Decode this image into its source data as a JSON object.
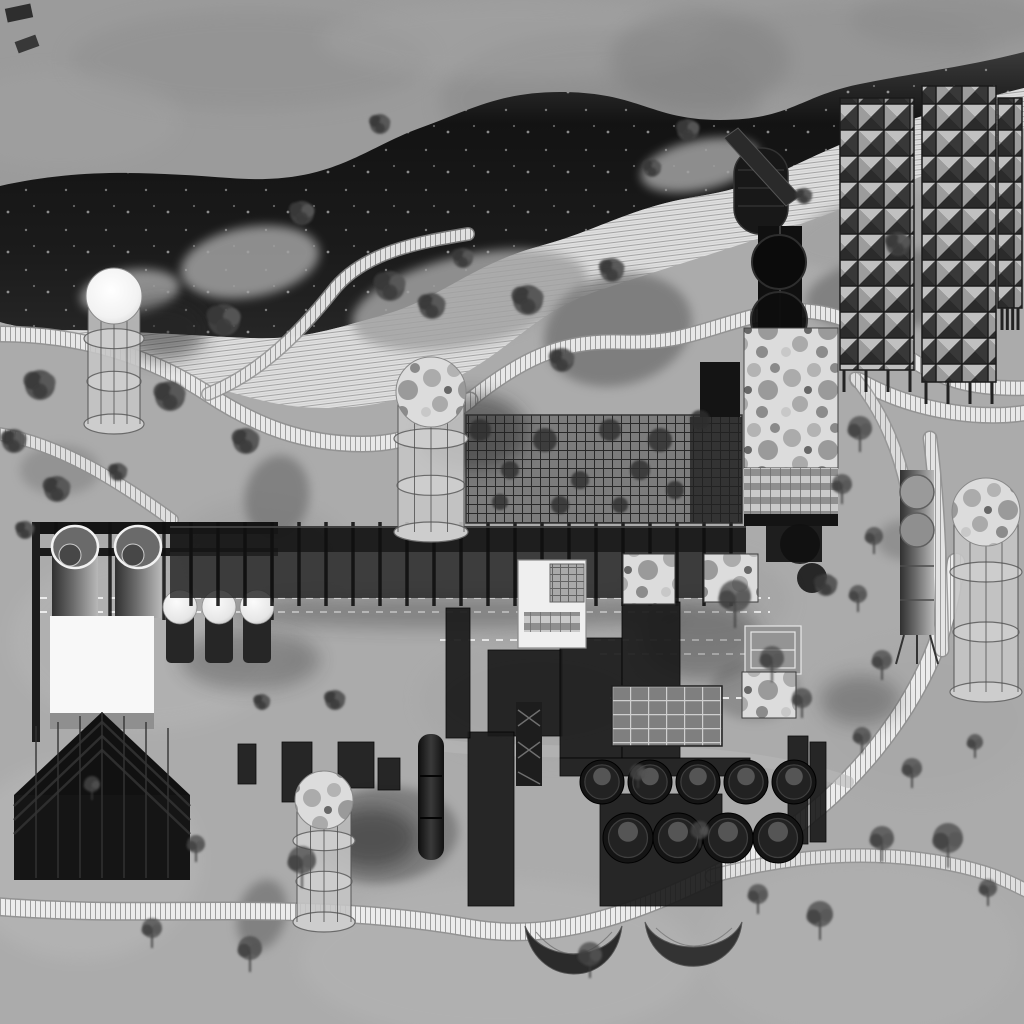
{
  "meta": {
    "title": "industrial-park-masterplan-rendering",
    "view": "aerial site plan, grayscale architectural rendering",
    "visible_text": []
  },
  "palette": {
    "ground": "#ababab",
    "ground-light": "#bfbfbf",
    "sky": "#9b9b9b",
    "hill": "#161616",
    "stripe-bg": "#e3e3e3",
    "stripe-line": "#a3a3a3",
    "boardwalk": "#ececec",
    "pond": "#6f6f6f",
    "structure-dark": "#141414",
    "structure-mid": "#2c2c2c",
    "concrete": "#c6c6c6",
    "white": "#f8f8f8",
    "mottle": "#dcdcdc",
    "glass": "#c9c9c9",
    "tree": "#454545",
    "shadow": "#262626"
  },
  "features": {
    "clouds": [
      {
        "x": 250,
        "y": 60,
        "rx": 180,
        "ry": 50,
        "c": "#8e8e8e",
        "o": 0.5
      },
      {
        "x": 600,
        "y": 100,
        "rx": 160,
        "ry": 70,
        "c": "#878787",
        "o": 0.5
      },
      {
        "x": 520,
        "y": 40,
        "rx": 200,
        "ry": 40,
        "c": "#a6a6a6",
        "o": 0.4
      },
      {
        "x": 840,
        "y": 50,
        "rx": 150,
        "ry": 45,
        "c": "#909090",
        "o": 0.45
      },
      {
        "x": 60,
        "y": 120,
        "rx": 120,
        "ry": 50,
        "c": "#a3a3a3",
        "o": 0.4
      },
      {
        "x": 950,
        "y": 20,
        "rx": 100,
        "ry": 30,
        "c": "#858585",
        "o": 0.4
      },
      {
        "x": 700,
        "y": 60,
        "rx": 90,
        "ry": 50,
        "c": "#7d7d7d",
        "o": 0.45
      }
    ],
    "groundPatches": [
      {
        "x": 150,
        "y": 640,
        "rx": 140,
        "ry": 90,
        "c": "#bcbcbc",
        "o": 0.35
      },
      {
        "x": 80,
        "y": 860,
        "rx": 120,
        "ry": 100,
        "c": "#c0c0c0",
        "o": 0.35
      },
      {
        "x": 500,
        "y": 960,
        "rx": 200,
        "ry": 80,
        "c": "#bdbdbd",
        "o": 0.3
      },
      {
        "x": 860,
        "y": 950,
        "rx": 160,
        "ry": 90,
        "c": "#b5b5b5",
        "o": 0.3
      },
      {
        "x": 920,
        "y": 720,
        "rx": 120,
        "ry": 80,
        "c": "#a5a5a5",
        "o": 0.35
      },
      {
        "x": 260,
        "y": 560,
        "rx": 90,
        "ry": 60,
        "c": "#989898",
        "o": 0.35
      },
      {
        "x": 700,
        "y": 600,
        "rx": 90,
        "ry": 50,
        "c": "#9a9a9a",
        "o": 0.3
      },
      {
        "x": 540,
        "y": 700,
        "rx": 120,
        "ry": 60,
        "c": "#a0a0a0",
        "o": 0.3
      }
    ],
    "ponds": [
      {
        "x": 618,
        "y": 330,
        "rx": 75,
        "ry": 55,
        "rot": -15,
        "o": 0.75
      },
      {
        "x": 900,
        "y": 290,
        "rx": 95,
        "ry": 38,
        "rot": -8,
        "o": 0.7
      },
      {
        "x": 277,
        "y": 497,
        "rx": 32,
        "ry": 42,
        "rot": 10,
        "o": 0.7
      },
      {
        "x": 383,
        "y": 835,
        "rx": 75,
        "ry": 48,
        "rot": -5,
        "o": 0.75
      },
      {
        "x": 262,
        "y": 915,
        "rx": 24,
        "ry": 36,
        "rot": 15,
        "o": 0.7
      },
      {
        "x": 60,
        "y": 470,
        "rx": 40,
        "ry": 25,
        "rot": 0,
        "o": 0.4
      },
      {
        "x": 755,
        "y": 690,
        "rx": 45,
        "ry": 30,
        "rot": 0,
        "o": 0.5
      },
      {
        "x": 905,
        "y": 540,
        "rx": 28,
        "ry": 20,
        "rot": 0,
        "o": 0.45
      }
    ],
    "grassIslands": [
      {
        "x": 470,
        "y": 300,
        "rx": 120,
        "ry": 45,
        "rot": -12
      },
      {
        "x": 250,
        "y": 262,
        "rx": 70,
        "ry": 35,
        "rot": -10
      },
      {
        "x": 700,
        "y": 165,
        "rx": 60,
        "ry": 25,
        "rot": -12
      },
      {
        "x": 880,
        "y": 232,
        "rx": 90,
        "ry": 35,
        "rot": -10
      },
      {
        "x": 130,
        "y": 292,
        "rx": 50,
        "ry": 22,
        "rot": -8
      }
    ],
    "boardwalks": [
      {
        "d": "M-10,906 C150,920 300,898 470,928 C560,944 645,908 712,876 C800,834 862,776 906,706 C938,654 950,612 956,562",
        "w": 16,
        "o": 1
      },
      {
        "d": "M712,876 C790,856 868,848 950,864 C1000,874 1015,886 1030,892",
        "w": 12,
        "o": 0.85
      },
      {
        "d": "M930,438 C938,500 940,560 942,650",
        "w": 12,
        "o": 0.9
      },
      {
        "d": "M858,380 C920,415 990,420 1030,412",
        "w": 14,
        "o": 0.95
      },
      {
        "d": "M470,400 C520,360 560,340 620,342 C680,344 700,330 755,316 C820,300 860,322 900,352 C940,380 970,390 1030,388",
        "w": 13,
        "o": 0.95
      },
      {
        "d": "M0,334 C80,334 150,356 208,394 C258,427 305,444 362,444 C420,444 442,420 470,400",
        "w": 14,
        "o": 0.95
      },
      {
        "d": "M0,434 C60,444 120,482 172,520",
        "w": 11,
        "o": 0.85
      },
      {
        "d": "M208,394 C262,372 300,332 332,292 C362,252 420,242 468,234",
        "w": 11,
        "o": 0.9
      },
      {
        "d": "M855,378 C890,420 905,470 912,520",
        "w": 10,
        "o": 0.8
      }
    ],
    "rails": [
      {
        "x1": 40,
        "y": 598,
        "x2": 770
      },
      {
        "x1": 40,
        "y": 612,
        "x2": 770
      },
      {
        "x1": 440,
        "y": 640,
        "x2": 790
      },
      {
        "x1": 600,
        "y": 654,
        "x2": 790
      },
      {
        "x1": 610,
        "y": 698,
        "x2": 786
      }
    ],
    "road": {
      "d": "M428,744 C520,756 640,748 720,756 C780,762 820,772 848,782",
      "w": 12,
      "o": 0.6
    },
    "shadows": [
      {
        "x": 162,
        "y": 330,
        "rx": 45,
        "ry": 30,
        "o": 0.5
      },
      {
        "x": 472,
        "y": 432,
        "rx": 55,
        "ry": 38,
        "o": 0.5
      },
      {
        "x": 372,
        "y": 838,
        "rx": 45,
        "ry": 30,
        "o": 0.5
      },
      {
        "x": 455,
        "y": 612,
        "rx": 230,
        "ry": 16,
        "o": 0.3
      },
      {
        "x": 700,
        "y": 640,
        "rx": 60,
        "ry": 40,
        "o": 0.35
      },
      {
        "x": 250,
        "y": 660,
        "rx": 70,
        "ry": 30,
        "o": 0.3
      },
      {
        "x": 860,
        "y": 700,
        "rx": 40,
        "ry": 25,
        "o": 0.3
      }
    ],
    "towers": [
      {
        "cx": 114,
        "top": 296,
        "w": 52,
        "h": 128,
        "dome": "white"
      },
      {
        "cx": 431,
        "top": 392,
        "w": 66,
        "h": 140,
        "dome": "mottle"
      },
      {
        "cx": 324,
        "top": 800,
        "w": 54,
        "h": 122,
        "dome": "mottle"
      },
      {
        "cx": 986,
        "top": 512,
        "w": 64,
        "h": 180,
        "dome": "mottle"
      }
    ],
    "slabs": [
      {
        "x": 840,
        "y": 98,
        "w": 74,
        "h": 272
      },
      {
        "x": 922,
        "y": 86,
        "w": 74,
        "h": 296
      },
      {
        "x": 998,
        "y": 98,
        "w": 24,
        "h": 210
      }
    ],
    "tankRows": [
      {
        "cy": 782,
        "r": 22,
        "cx": [
          602,
          650,
          698,
          746,
          794
        ]
      },
      {
        "cy": 838,
        "r": 25,
        "cx": [
          628,
          678,
          728,
          778
        ]
      }
    ],
    "spheres": [
      {
        "x": 180,
        "y": 607
      },
      {
        "x": 219,
        "y": 607
      },
      {
        "x": 257,
        "y": 607
      }
    ],
    "sphereR": 17,
    "mottledRoofs": [
      {
        "x": 623,
        "y": 554,
        "w": 52,
        "h": 50
      },
      {
        "x": 704,
        "y": 554,
        "w": 54,
        "h": 48
      },
      {
        "x": 742,
        "y": 672,
        "w": 54,
        "h": 46
      }
    ],
    "sheds": [
      [
        488,
        650,
        74,
        86
      ],
      [
        560,
        638,
        62,
        120
      ],
      [
        622,
        602,
        58,
        156
      ],
      [
        468,
        732,
        46,
        174
      ],
      [
        600,
        794,
        122,
        112
      ],
      [
        282,
        742,
        30,
        60
      ],
      [
        338,
        742,
        36,
        46
      ],
      [
        378,
        758,
        22,
        32
      ],
      [
        788,
        736,
        20,
        108
      ],
      [
        810,
        742,
        16,
        100
      ],
      [
        446,
        608,
        24,
        130
      ],
      [
        238,
        744,
        18,
        40
      ],
      [
        560,
        758,
        190,
        18
      ]
    ],
    "vines": [
      [
        480,
        430,
        11
      ],
      [
        510,
        470,
        9
      ],
      [
        545,
        440,
        12
      ],
      [
        580,
        480,
        9
      ],
      [
        610,
        430,
        11
      ],
      [
        640,
        470,
        10
      ],
      [
        500,
        502,
        8
      ],
      [
        560,
        505,
        9
      ],
      [
        620,
        505,
        8
      ],
      [
        660,
        440,
        12
      ],
      [
        675,
        490,
        9
      ],
      [
        700,
        420,
        10
      ]
    ],
    "trees": [
      [
        40,
        385,
        15,
        0
      ],
      [
        14,
        441,
        12,
        0
      ],
      [
        57,
        489,
        13,
        0
      ],
      [
        118,
        472,
        9,
        0
      ],
      [
        170,
        396,
        15,
        0
      ],
      [
        224,
        320,
        16,
        0
      ],
      [
        246,
        441,
        13,
        0
      ],
      [
        302,
        213,
        12,
        0
      ],
      [
        380,
        124,
        10,
        0
      ],
      [
        463,
        258,
        10,
        0
      ],
      [
        390,
        286,
        15,
        0
      ],
      [
        432,
        306,
        13,
        0
      ],
      [
        528,
        300,
        15,
        0
      ],
      [
        562,
        360,
        12,
        0
      ],
      [
        612,
        270,
        12,
        0
      ],
      [
        688,
        130,
        11,
        0
      ],
      [
        652,
        168,
        9,
        0
      ],
      [
        898,
        244,
        12,
        0
      ],
      [
        804,
        196,
        8,
        0
      ],
      [
        860,
        452,
        12,
        1
      ],
      [
        842,
        504,
        10,
        1
      ],
      [
        874,
        554,
        9,
        1
      ],
      [
        826,
        585,
        11,
        0
      ],
      [
        858,
        612,
        9,
        1
      ],
      [
        735,
        628,
        16,
        1
      ],
      [
        772,
        682,
        12,
        1
      ],
      [
        802,
        718,
        10,
        1
      ],
      [
        882,
        680,
        10,
        1
      ],
      [
        25,
        530,
        9,
        0
      ],
      [
        335,
        700,
        10,
        0
      ],
      [
        262,
        702,
        8,
        0
      ],
      [
        250,
        972,
        12,
        1
      ],
      [
        302,
        888,
        14,
        1
      ],
      [
        152,
        948,
        10,
        1
      ],
      [
        590,
        978,
        12,
        1
      ],
      [
        758,
        914,
        10,
        1
      ],
      [
        820,
        940,
        13,
        1
      ],
      [
        882,
        862,
        12,
        1
      ],
      [
        948,
        868,
        15,
        1
      ],
      [
        988,
        906,
        9,
        1
      ],
      [
        700,
        848,
        9,
        1
      ],
      [
        912,
        788,
        10,
        1
      ],
      [
        862,
        754,
        9,
        1
      ],
      [
        638,
        788,
        8,
        1
      ],
      [
        975,
        758,
        8,
        1
      ],
      [
        196,
        862,
        9,
        1
      ],
      [
        92,
        800,
        8,
        1
      ]
    ]
  }
}
